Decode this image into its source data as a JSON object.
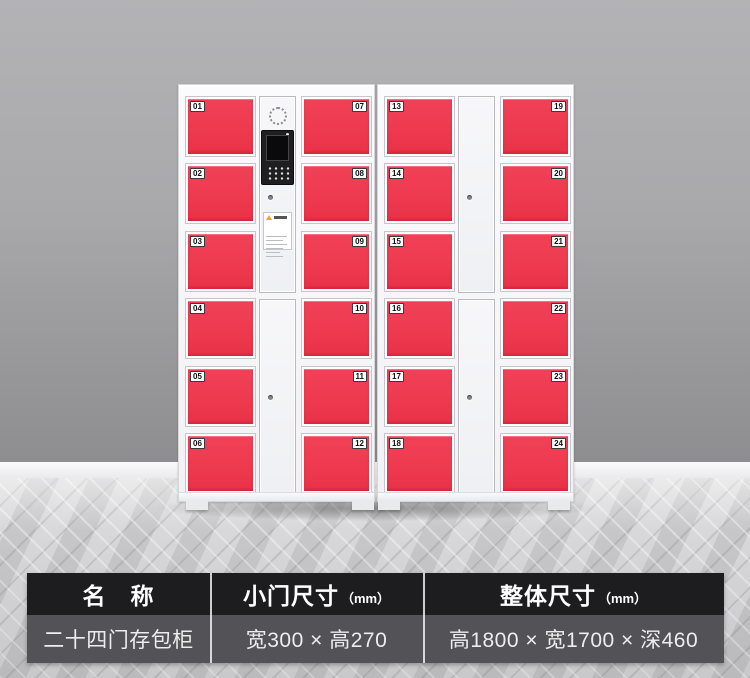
{
  "product": {
    "name": "二十四门存包柜",
    "doors": [
      "01",
      "02",
      "03",
      "04",
      "05",
      "06",
      "07",
      "08",
      "09",
      "10",
      "11",
      "12",
      "13",
      "14",
      "15",
      "16",
      "17",
      "18",
      "19",
      "20",
      "21",
      "22",
      "23",
      "24"
    ]
  },
  "colors": {
    "door_red": "#ee3a4f",
    "cabinet_white": "#f5f5f8",
    "table_header_bg": "#1d1d1f",
    "table_row_bg": "#525257"
  },
  "spec_table": {
    "columns": [
      {
        "header": "名　称",
        "unit": "",
        "value": "二十四门存包柜"
      },
      {
        "header": "小门尺寸",
        "unit": "（mm）",
        "value": "宽300 × 高270"
      },
      {
        "header": "整体尺寸",
        "unit": "（mm）",
        "value": "高1800 × 宽1700 × 深460"
      }
    ]
  }
}
